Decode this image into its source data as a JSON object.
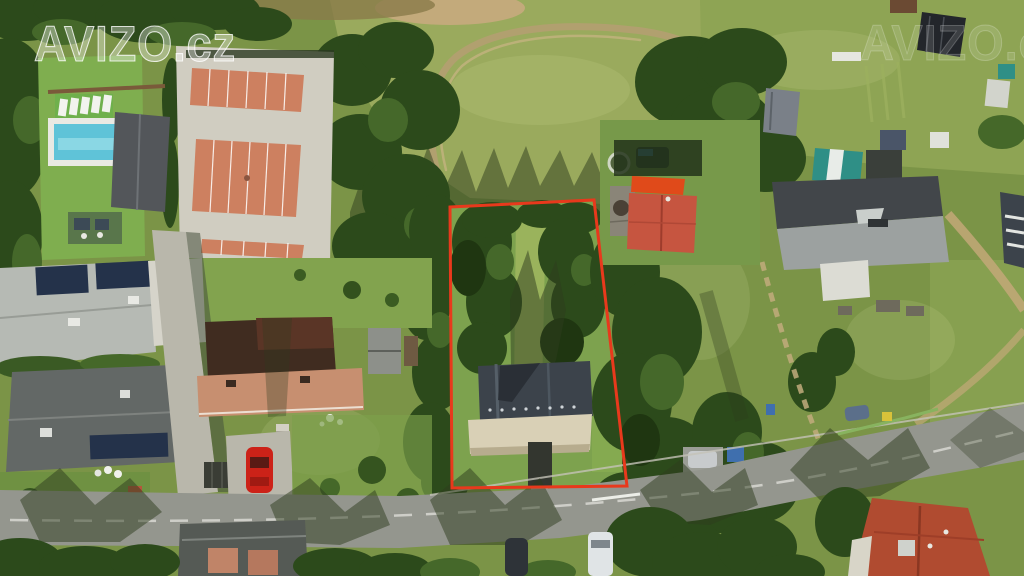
{
  "watermark": {
    "text": "AVIZO.cz",
    "partial_text": "AVIZO.cz",
    "color": "#ffffff"
  },
  "scene": {
    "description": "Aerial drone photograph of a village building plot for sale, outlined in red, with neighbouring houses, tennis courts, swimming pool, meadow and a road along the bottom",
    "boundary": {
      "points": "450,207 594,200 627,486 452,488",
      "color": "#e8391c"
    }
  },
  "palette": {
    "grass": "#7b9447",
    "meadow": "#9aaa5d",
    "garden": "#8ea454",
    "dry_grass": "#c3aa7b",
    "road": "#94968e",
    "concrete": "#b9b7ab",
    "dirt_path": "#b59f72",
    "pool_water": "#5fc3d8",
    "pool_deck": "#e9e9e3",
    "tennis_clay": "#cd8060",
    "tennis_base": "#d0cdc1",
    "roof_dark": "#53565a",
    "roof_light_gray": "#b6bab4",
    "roof_graphite": "#636866",
    "roof_brown": "#402c20",
    "roof_salmon": "#c78f70",
    "roof_orange": "#e04a1a",
    "roof_red": "#c65540",
    "roof_big_dark": "#42464a",
    "roof_big_light": "#9ca1a0",
    "roof_terracotta": "#b04b30",
    "roof_slate": "#3c434b",
    "terrace": "#d9d0b6",
    "solar": "#24324a",
    "car_red": "#cc2218",
    "van_white": "#e0e4e6",
    "tarp_teal": "#2f8f86"
  }
}
